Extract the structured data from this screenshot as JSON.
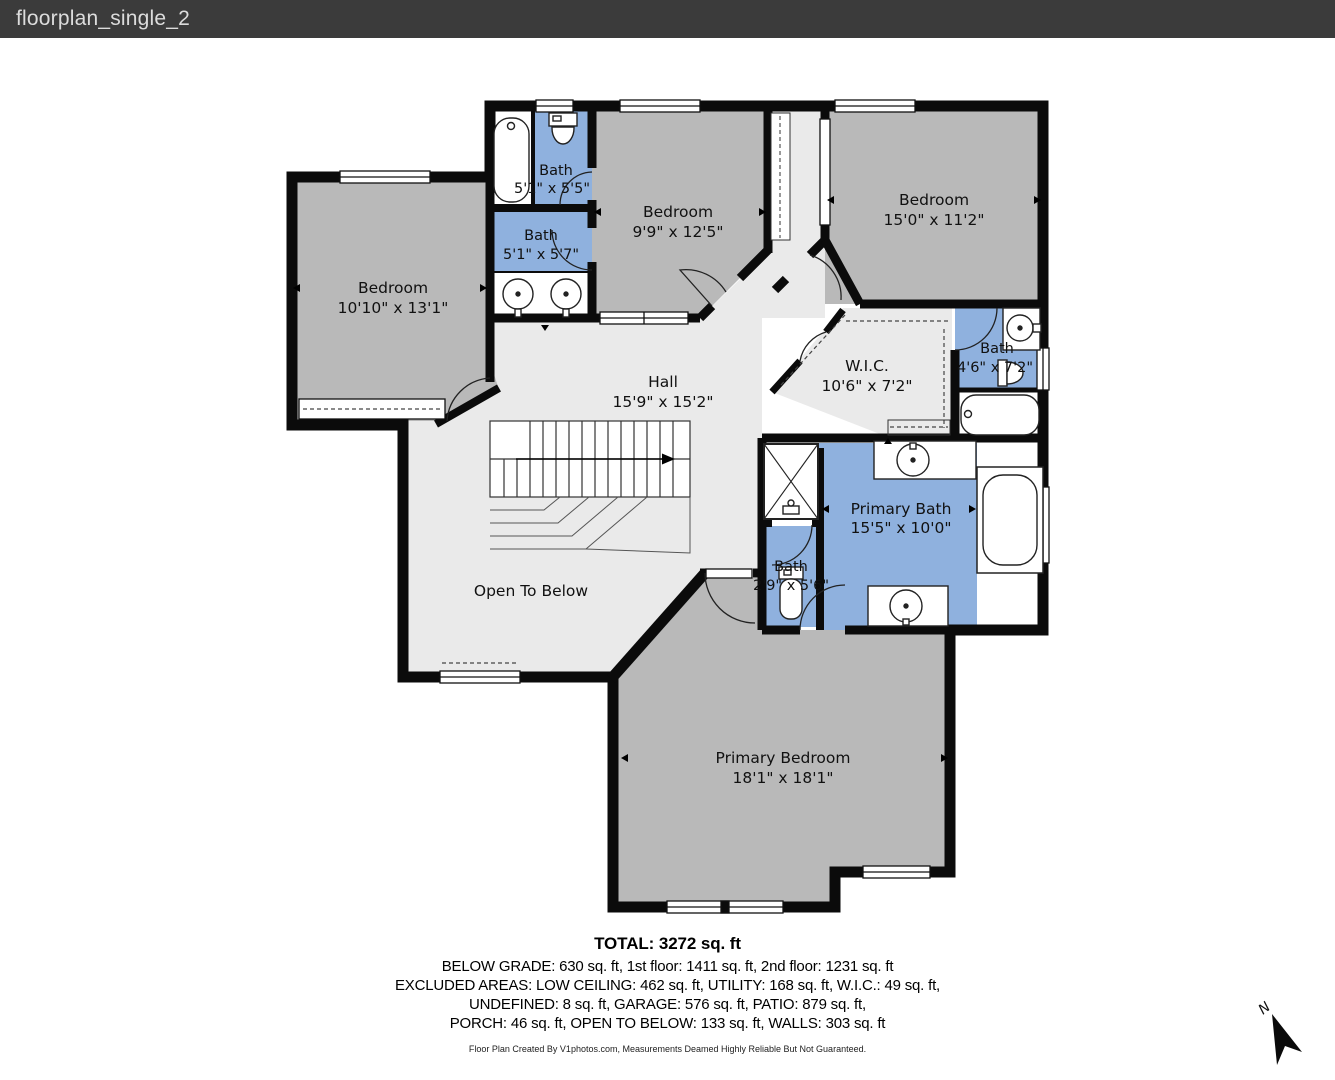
{
  "header": {
    "title": "floorplan_single_2"
  },
  "floorplan": {
    "rooms": {
      "left_bedroom": {
        "name": "Bedroom",
        "dims": "10'10\" x 13'1\""
      },
      "bath_top": {
        "name": "Bath",
        "dims": "5'1\" x 5'5\""
      },
      "bath_mid": {
        "name": "Bath",
        "dims": "5'1\" x 5'7\""
      },
      "bedroom_2": {
        "name": "Bedroom",
        "dims": "9'9\" x 12'5\""
      },
      "bedroom_3": {
        "name": "Bedroom",
        "dims": "15'0\" x 11'2\""
      },
      "wic": {
        "name": "W.I.C.",
        "dims": "10'6\" x 7'2\""
      },
      "hall": {
        "name": "Hall",
        "dims": "15'9\" x 15'2\""
      },
      "bath_right": {
        "name": "Bath",
        "dims": "4'6\" x 7'2\""
      },
      "primary_bath": {
        "name": "Primary Bath",
        "dims": "15'5\" x 10'0\""
      },
      "bath_small": {
        "name": "Bath",
        "dims": "2'9\" x 5'6\""
      },
      "primary_bedroom": {
        "name": "Primary Bedroom",
        "dims": "18'1\" x 18'1\""
      },
      "open_to_below": {
        "name": "Open To Below"
      }
    },
    "compass": {
      "label": "N"
    }
  },
  "summary": {
    "total": "TOTAL: 3272 sq. ft",
    "lines": [
      "BELOW GRADE: 630 sq. ft, 1st floor: 1411 sq. ft, 2nd floor: 1231 sq. ft",
      "EXCLUDED AREAS: LOW CEILING: 462 sq. ft, UTILITY: 168 sq. ft, W.I.C.: 49 sq. ft,",
      "UNDEFINED: 8 sq. ft, GARAGE: 576 sq. ft, PATIO: 879 sq. ft,",
      "PORCH: 46 sq. ft, OPEN TO BELOW: 133 sq. ft, WALLS: 303 sq. ft"
    ],
    "disclaimer": "Floor Plan Created By V1photos.com, Measurements Deamed Highly Reliable But Not Guaranteed."
  },
  "colors": {
    "wall": "#0b0b0b",
    "bedroom_fill": "#b9b9b9",
    "floor_fill": "#eaeaea",
    "bath_fill": "#8fb1de",
    "header_bg": "#3b3b3b"
  }
}
